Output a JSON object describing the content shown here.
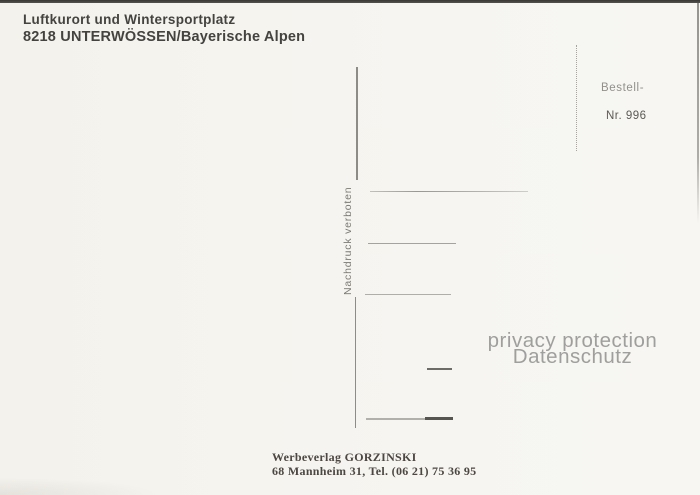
{
  "header": {
    "line1": "Luftkurort und Wintersportplatz",
    "line2": "8218 UNTERWÖSSEN/Bayerische Alpen"
  },
  "stamp_area": {
    "order_label": "Bestell-",
    "order_number": "Nr. 996"
  },
  "divider": {
    "copyright_notice": "Nachdruck verboten"
  },
  "watermark": {
    "line1": "privacy protection",
    "line2": "Datenschutz"
  },
  "publisher": {
    "line1": "Werbeverlag GORZINSKI",
    "line2": "68 Mannheim 31, Tel. (06 21) 75 36 95"
  },
  "colors": {
    "background": "#f4f2ec",
    "ink": "#454340",
    "light_ink": "#92908b",
    "divider": "#8e8c87",
    "watermark": "#9f9f9d"
  }
}
